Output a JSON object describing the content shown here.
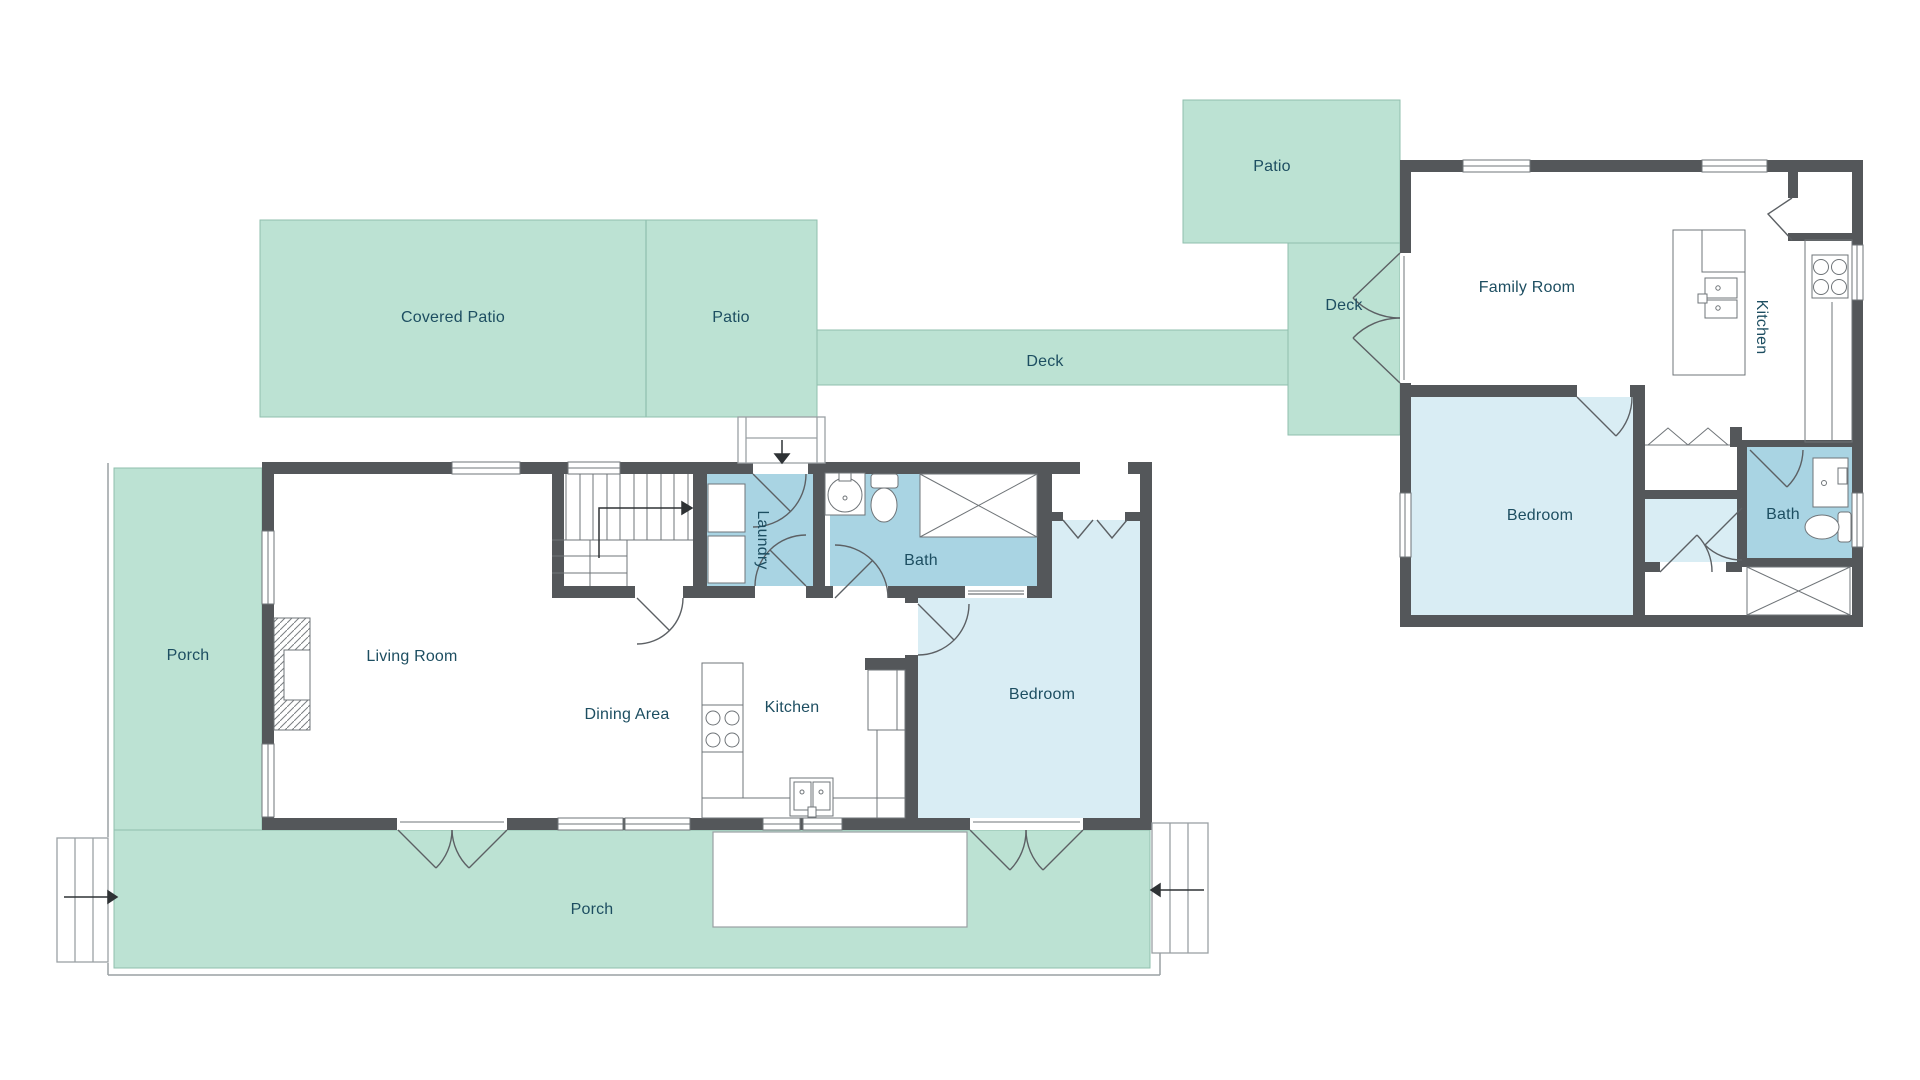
{
  "title": "Floor plan",
  "colors": {
    "outdoor_green": "#bce2d3",
    "outdoor_border": "#8fbfae",
    "room_lightblue": "#d9edf4",
    "room_blue": "#a9d4e3",
    "wall": "#54575a",
    "line": "#6f7478",
    "outline": "#9aa0a4",
    "label": "#1d4e61",
    "arrow": "#2e3235",
    "page_bg": "#ffffff"
  },
  "labels": {
    "covered_patio": "Covered Patio",
    "patio_left": "Patio",
    "deck_strip": "Deck",
    "patio_right": "Patio",
    "deck_right": "Deck",
    "porch_left": "Porch",
    "porch_bottom": "Porch",
    "living_room": "Living Room",
    "dining_area": "Dining Area",
    "kitchen_left": "Kitchen",
    "laundry": "Laundry",
    "bath_left": "Bath",
    "bedroom_left": "Bedroom",
    "family_room": "Family Room",
    "kitchen_right": "Kitchen",
    "bedroom_right": "Bedroom",
    "bath_right": "Bath"
  }
}
